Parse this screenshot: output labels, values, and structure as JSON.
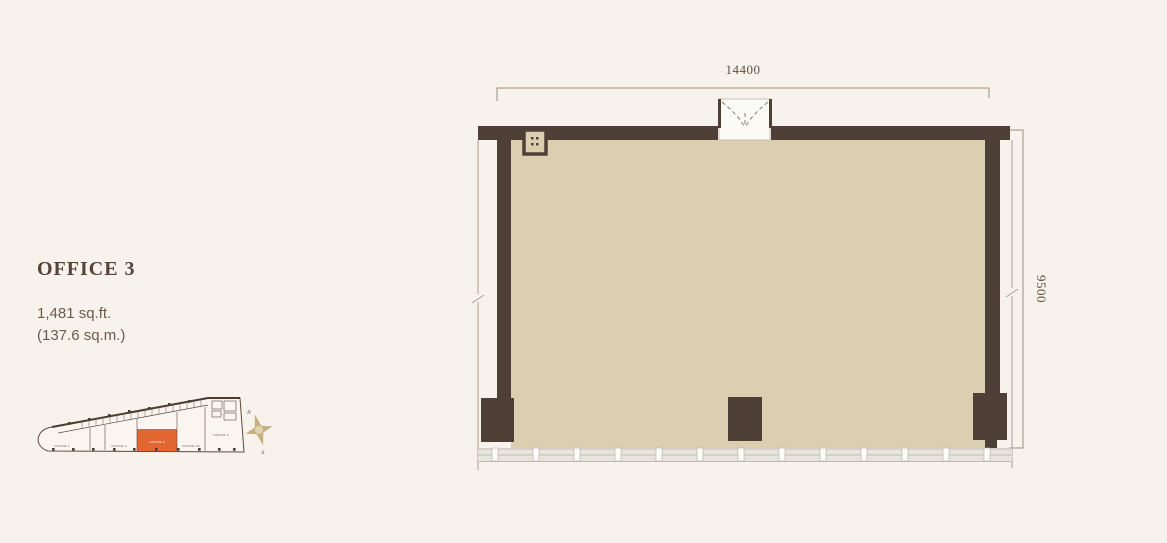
{
  "unit": {
    "title": "OFFICE 3",
    "area_sqft": "1,481 sq.ft.",
    "area_sqm": "(137.6 sq.m.)"
  },
  "floorplan": {
    "dim_width": "14400",
    "dim_height": "9500",
    "window_mullion_count": 13,
    "wall_color": "#4e4036",
    "floor_color": "#dccfb1"
  },
  "keyplan": {
    "units": [
      {
        "label": "OFFICE 1",
        "highlight": false
      },
      {
        "label": "OFFICE 2",
        "highlight": false
      },
      {
        "label": "OFFICE 3",
        "highlight": true
      },
      {
        "label": "OFFICE 3A",
        "highlight": false
      },
      {
        "label": "OFFICE 5",
        "highlight": false
      }
    ],
    "highlight_color": "#e2662f"
  },
  "compass": {
    "north": "N",
    "south": "S"
  }
}
